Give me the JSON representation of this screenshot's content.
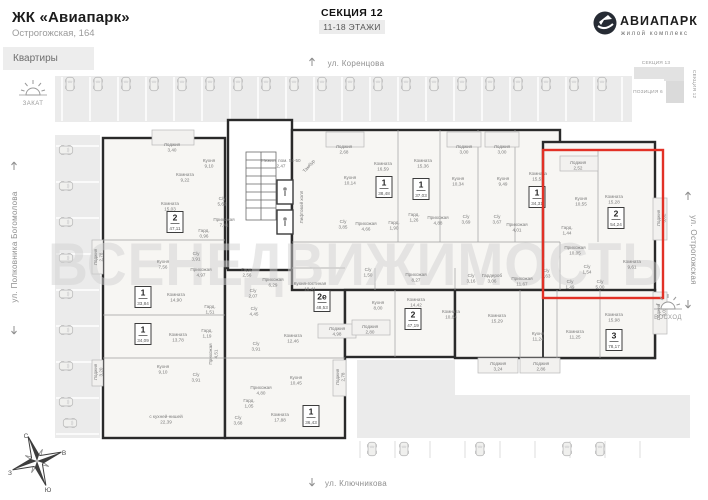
{
  "header": {
    "complex": "ЖК «Авиапарк»",
    "address": "Острогожская, 164",
    "tab": "Квартиры",
    "section": "СЕКЦИЯ 12",
    "floors": "11-18 ЭТАЖИ"
  },
  "logo": {
    "title": "АВИАПАРК",
    "subtitle": "жилой комплекс"
  },
  "minimap": {
    "top": "СЕКЦИЯ 13",
    "right": "СЕКЦИЯ 12",
    "position": "ПОЗИЦИЯ 6"
  },
  "streets": {
    "top": "ул. Коренцова",
    "bottom": "ул. Ключникова",
    "left": "ул. Полковника Богомолова",
    "right": "ул. Острогожская"
  },
  "sun": {
    "sunset": "ЗАКАТ",
    "sunrise": "ВОСХОД"
  },
  "compass": {
    "n": "С",
    "e": "В",
    "s": "Ю",
    "w": "З"
  },
  "watermark": "ВСЕНЕДВИЖИМОСТЬ",
  "selected_apartment": {
    "rooms": "2",
    "area_m2": "54,24"
  },
  "colors": {
    "highlight": "#e23126",
    "wall": "#2a2a2a",
    "street": "#ebebeb",
    "building": "#f7f6f3"
  },
  "plan": {
    "badges": [
      {
        "n": "2",
        "a": "47,11",
        "x": 175,
        "y": 222
      },
      {
        "n": "1",
        "a": "33,84",
        "x": 143,
        "y": 297
      },
      {
        "n": "1",
        "a": "34,09",
        "x": 143,
        "y": 334
      },
      {
        "n": "1",
        "a": "36,43",
        "x": 311,
        "y": 416
      },
      {
        "n": "2е",
        "a": "48,53",
        "x": 322,
        "y": 301
      },
      {
        "n": "1",
        "a": "38,48",
        "x": 384,
        "y": 187
      },
      {
        "n": "1",
        "a": "37,03",
        "x": 421,
        "y": 189
      },
      {
        "n": "1",
        "a": "34,31",
        "x": 537,
        "y": 197
      },
      {
        "n": "2",
        "a": "54,24",
        "x": 616,
        "y": 218,
        "hl": 1
      },
      {
        "n": "3",
        "a": "78,17",
        "x": 614,
        "y": 340
      },
      {
        "n": "2",
        "a": "47,19",
        "x": 413,
        "y": 319
      }
    ],
    "rooms": [
      {
        "n": "Лоджия",
        "a": "3,40",
        "x": 172,
        "y": 146
      },
      {
        "n": "Комната",
        "a": "9,22",
        "x": 185,
        "y": 176
      },
      {
        "n": "Кухня",
        "a": "9,10",
        "x": 209,
        "y": 162
      },
      {
        "n": "Комната",
        "a": "15,03",
        "x": 170,
        "y": 205
      },
      {
        "n": "С/у",
        "a": "5,69",
        "x": 222,
        "y": 200
      },
      {
        "n": "Прихожая",
        "a": "7,41",
        "x": 224,
        "y": 221
      },
      {
        "n": "Гард.",
        "a": "0,96",
        "x": 204,
        "y": 232
      },
      {
        "n": "Лоджия",
        "a": "2,78",
        "x": 97,
        "y": 257,
        "r": -90
      },
      {
        "n": "Кухня",
        "a": "7,56",
        "x": 163,
        "y": 263
      },
      {
        "n": "С/у",
        "a": "3,91",
        "x": 196,
        "y": 255
      },
      {
        "n": "Прихожая",
        "a": "4,97",
        "x": 201,
        "y": 271
      },
      {
        "n": "Комната",
        "a": "14,90",
        "x": 176,
        "y": 296
      },
      {
        "n": "Гард.",
        "a": "1,51",
        "x": 210,
        "y": 308
      },
      {
        "n": "Комната",
        "a": "13,78",
        "x": 178,
        "y": 336
      },
      {
        "n": "Гард.",
        "a": "1,19",
        "x": 207,
        "y": 332
      },
      {
        "n": "Прихожая",
        "a": "4,51",
        "x": 212,
        "y": 354,
        "r": -90
      },
      {
        "n": "Лоджия",
        "a": "3,20",
        "x": 97,
        "y": 372,
        "r": -90
      },
      {
        "n": "Кухня",
        "a": "9,10",
        "x": 163,
        "y": 368
      },
      {
        "n": "С/у",
        "a": "3,91",
        "x": 196,
        "y": 376
      },
      {
        "n": "с кухней-нишей",
        "a": "22,39",
        "x": 166,
        "y": 418
      },
      {
        "n": "С/у",
        "a": "3,68",
        "x": 238,
        "y": 419
      },
      {
        "n": "Гард.",
        "a": "2,56",
        "x": 247,
        "y": 271
      },
      {
        "n": "Прихожая",
        "a": "6,29",
        "x": 273,
        "y": 281
      },
      {
        "n": "С/у",
        "a": "2,07",
        "x": 253,
        "y": 292
      },
      {
        "n": "Кухня-гостиная",
        "a": "18,41",
        "x": 310,
        "y": 285
      },
      {
        "n": "С/у",
        "a": "4,45",
        "x": 254,
        "y": 310
      },
      {
        "n": "С/у",
        "a": "3,91",
        "x": 256,
        "y": 345
      },
      {
        "n": "Комната",
        "a": "12,46",
        "x": 293,
        "y": 337
      },
      {
        "n": "Лоджия",
        "a": "4,98",
        "x": 337,
        "y": 330
      },
      {
        "n": "Прихожая",
        "a": "4,80",
        "x": 261,
        "y": 389
      },
      {
        "n": "Гард.",
        "a": "1,05",
        "x": 249,
        "y": 402
      },
      {
        "n": "Кухня",
        "a": "10,45",
        "x": 296,
        "y": 379
      },
      {
        "n": "Лоджия",
        "a": "2,78",
        "x": 339,
        "y": 377,
        "r": -90
      },
      {
        "n": "Комната",
        "a": "17,88",
        "x": 280,
        "y": 416
      },
      {
        "n": "Кухня",
        "a": "8,00",
        "x": 378,
        "y": 304
      },
      {
        "n": "Комната",
        "a": "14,42",
        "x": 416,
        "y": 301
      },
      {
        "n": "Прихожая",
        "a": "8,27",
        "x": 416,
        "y": 276
      },
      {
        "n": "С/у",
        "a": "1,50",
        "x": 368,
        "y": 271
      },
      {
        "n": "Лоджия",
        "a": "2,80",
        "x": 370,
        "y": 328
      },
      {
        "n": "Комната",
        "a": "10,84",
        "x": 451,
        "y": 313
      },
      {
        "n": "Лоджия",
        "a": "2,68",
        "x": 344,
        "y": 148
      },
      {
        "n": "Кухня",
        "a": "10,14",
        "x": 350,
        "y": 179
      },
      {
        "n": "Комната",
        "a": "16,59",
        "x": 383,
        "y": 165
      },
      {
        "n": "С/у",
        "a": "3,85",
        "x": 343,
        "y": 223
      },
      {
        "n": "Прихожая",
        "a": "4,66",
        "x": 366,
        "y": 225
      },
      {
        "n": "Гард.",
        "a": "1,90",
        "x": 394,
        "y": 224
      },
      {
        "n": "Комната",
        "a": "15,36",
        "x": 423,
        "y": 162
      },
      {
        "n": "Гард.",
        "a": "1,26",
        "x": 414,
        "y": 216
      },
      {
        "n": "Прихожая",
        "a": "4,88",
        "x": 438,
        "y": 219
      },
      {
        "n": "Кухня",
        "a": "10,34",
        "x": 458,
        "y": 180
      },
      {
        "n": "Лоджия",
        "a": "3,00",
        "x": 464,
        "y": 148
      },
      {
        "n": "С/у",
        "a": "3,69",
        "x": 466,
        "y": 218
      },
      {
        "n": "Лоджия",
        "a": "3,00",
        "x": 502,
        "y": 148
      },
      {
        "n": "Кухня",
        "a": "9,49",
        "x": 503,
        "y": 180
      },
      {
        "n": "С/у",
        "a": "3,67",
        "x": 497,
        "y": 218
      },
      {
        "n": "Прихожая",
        "a": "4,01",
        "x": 517,
        "y": 226
      },
      {
        "n": "Комната",
        "a": "15,59",
        "x": 538,
        "y": 175
      },
      {
        "n": "Лоджия",
        "a": "2,52",
        "x": 578,
        "y": 164
      },
      {
        "n": "Кухня",
        "a": "10,55",
        "x": 581,
        "y": 200
      },
      {
        "n": "Комната",
        "a": "15,28",
        "x": 614,
        "y": 198
      },
      {
        "n": "Лоджия",
        "a": "3,02",
        "x": 660,
        "y": 218,
        "r": -90
      },
      {
        "n": "Гард.",
        "a": "1,44",
        "x": 567,
        "y": 229
      },
      {
        "n": "Прихожая",
        "a": "10,05",
        "x": 575,
        "y": 249
      },
      {
        "n": "С/у",
        "a": "1,54",
        "x": 587,
        "y": 268
      },
      {
        "n": "С/у",
        "a": "1,49",
        "x": 570,
        "y": 283
      },
      {
        "n": "С/у",
        "a": "5,00",
        "x": 600,
        "y": 283
      },
      {
        "n": "Комната",
        "a": "9,61",
        "x": 632,
        "y": 263
      },
      {
        "n": "С/у",
        "a": "1,63",
        "x": 546,
        "y": 272
      },
      {
        "n": "Лоджия",
        "a": "3,02",
        "x": 660,
        "y": 312,
        "r": -90
      },
      {
        "n": "Комната",
        "a": "15,98",
        "x": 614,
        "y": 316
      },
      {
        "n": "С/у",
        "a": "3,16",
        "x": 471,
        "y": 277
      },
      {
        "n": "Гардероб",
        "a": "3,06",
        "x": 492,
        "y": 277
      },
      {
        "n": "Прихожая",
        "a": "11,67",
        "x": 522,
        "y": 280
      },
      {
        "n": "Комната",
        "a": "15,29",
        "x": 497,
        "y": 317
      },
      {
        "n": "Кухня",
        "a": "11,24",
        "x": 538,
        "y": 335
      },
      {
        "n": "Комната",
        "a": "11,25",
        "x": 575,
        "y": 333
      },
      {
        "n": "Лоджия",
        "a": "3,24",
        "x": 498,
        "y": 365
      },
      {
        "n": "Лоджия",
        "a": "2,86",
        "x": 541,
        "y": 365
      },
      {
        "n": "Нежил. пом. 54-50",
        "a": "2,47",
        "x": 281,
        "y": 162
      },
      {
        "n": "Тамбур",
        "x": 310,
        "y": 167,
        "r": -48
      },
      {
        "n": "Лифтовой холл",
        "x": 303,
        "y": 207,
        "r": -90
      }
    ]
  }
}
